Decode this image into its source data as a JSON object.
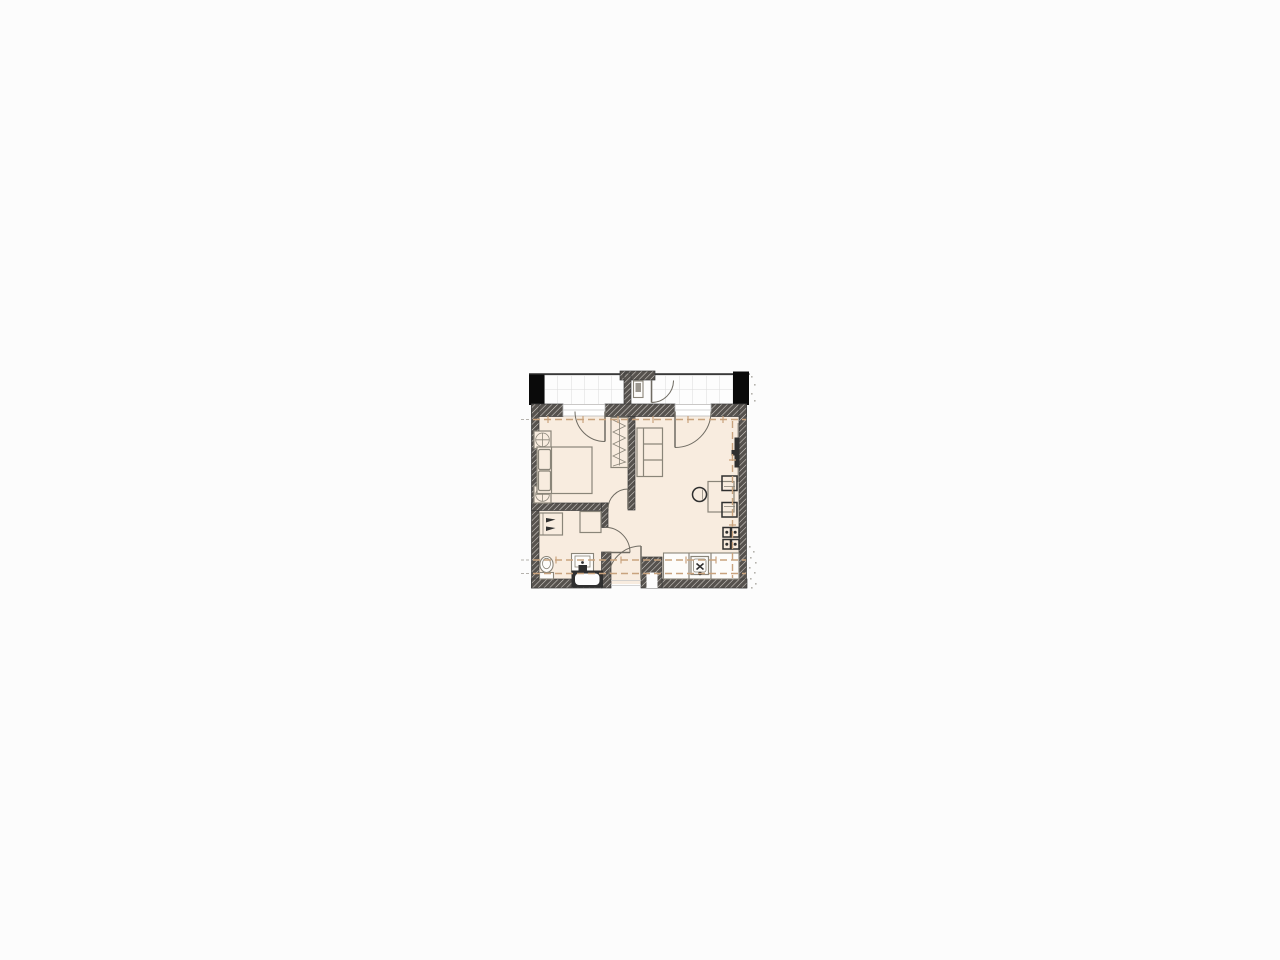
{
  "canvas": {
    "width": 1280,
    "height": 960,
    "background": "#fcfcfc"
  },
  "palette": {
    "page_bg": "#fcfcfc",
    "floor": "#f8ecdf",
    "balcony_tile": "#fdfdfd",
    "tile_line": "#dcdcdc",
    "wall": "#56524e",
    "wall_hatch": "#d8d4cf",
    "wall_outline": "#3a3a3a",
    "black_mass": "#0a0a0a",
    "furniture_line": "#8a8579",
    "dark_fixture": "#2f2f2f",
    "door_line": "#6f6b62",
    "dashed_axis": "#c9a37e",
    "exterior_dot": "#b5b2ad"
  },
  "floorplan": {
    "type": "apartment-floor-plan",
    "plan_bounds_px": {
      "x": 529,
      "y": 371,
      "width": 221,
      "height": 219
    },
    "areas": [
      "balcony",
      "balcony-storage",
      "bedroom",
      "living-kitchen",
      "hallway",
      "bathroom"
    ],
    "structural_columns": 2,
    "dashed_axis_lines": 4,
    "fixtures": [
      "double-bed",
      "pillows",
      "nightstand-top",
      "nightstand-bottom",
      "wardrobe-hangers",
      "sofa",
      "tv-panel",
      "dining-table",
      "dining-chair-top",
      "dining-chair-bottom",
      "dining-chair-left",
      "kitchen-counter",
      "kitchen-sink",
      "stove-burners",
      "tall-cabinet",
      "washing-machine",
      "shower-unit",
      "toilet",
      "bathroom-sink",
      "bathtub",
      "balcony-door-bedroom",
      "balcony-door-living",
      "bedroom-door",
      "bathroom-door",
      "entry-door",
      "storage-door"
    ]
  }
}
